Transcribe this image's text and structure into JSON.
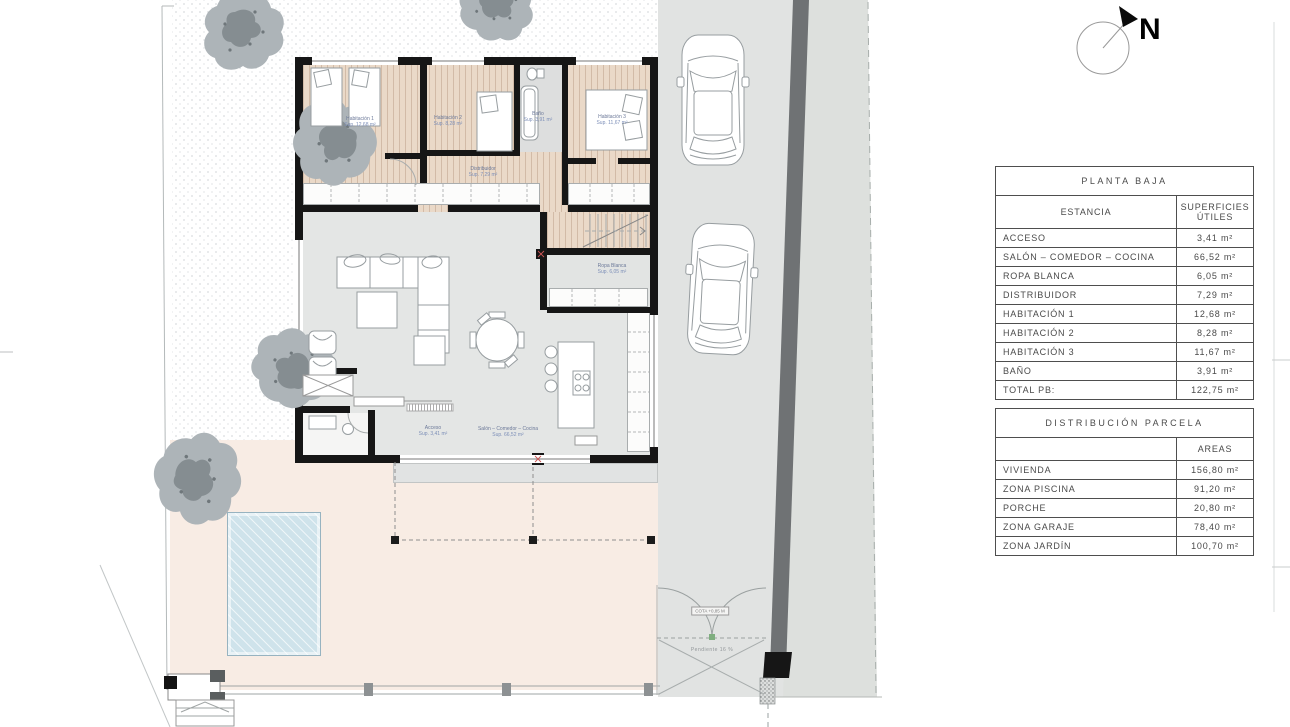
{
  "compass": {
    "north_label": "N"
  },
  "tables": {
    "planta_baja": {
      "title": "PLANTA BAJA",
      "col_room": "ESTANCIA",
      "col_area_line1": "SUPERFICIES",
      "col_area_line2": "ÚTILES",
      "rows": [
        {
          "name": "ACCESO",
          "value": "3,41 m²"
        },
        {
          "name": "SALÓN – COMEDOR – COCINA",
          "value": "66,52 m²"
        },
        {
          "name": "ROPA BLANCA",
          "value": "6,05 m²"
        },
        {
          "name": "DISTRIBUIDOR",
          "value": "7,29 m²"
        },
        {
          "name": "HABITACIÓN 1",
          "value": "12,68 m²"
        },
        {
          "name": "HABITACIÓN 2",
          "value": "8,28 m²"
        },
        {
          "name": "HABITACIÓN 3",
          "value": "11,67 m²"
        },
        {
          "name": "BAÑO",
          "value": "3,91 m²"
        },
        {
          "name": "TOTAL PB:",
          "value": "122,75 m²"
        }
      ]
    },
    "distribucion_parcela": {
      "title": "DISTRIBUCIÓN PARCELA",
      "col_area": "AREAS",
      "rows": [
        {
          "name": "VIVIENDA",
          "value": "156,80 m²"
        },
        {
          "name": "ZONA PISCINA",
          "value": "91,20 m²"
        },
        {
          "name": "PORCHE",
          "value": "20,80 m²"
        },
        {
          "name": "ZONA GARAJE",
          "value": "78,40 m²"
        },
        {
          "name": "ZONA JARDÍN",
          "value": "100,70 m²"
        }
      ]
    }
  },
  "plan_labels": {
    "habitacion1": {
      "name": "Habitación 1",
      "area": "Sup. 12,68 m²"
    },
    "habitacion2": {
      "name": "Habitación 2",
      "area": "Sup. 8,28 m²"
    },
    "habitacion3": {
      "name": "Habitación 3",
      "area": "Sup. 11,67 m²"
    },
    "bano": {
      "name": "Baño",
      "area": "Sup. 3,91 m²"
    },
    "distribuidor": {
      "name": "Distribuidor",
      "area": "Sup. 7,29 m²"
    },
    "ropa_blanca": {
      "name": "Ropa Blanca",
      "area": "Sup. 6,05 m²"
    },
    "acceso": {
      "name": "Acceso",
      "area": "Sup. 3,41 m²"
    },
    "salon": {
      "name": "Salón – Comedor – Cocina",
      "area": "Sup. 66,52 m²"
    },
    "cota": "COTA +0,85 M",
    "pendiente": "Pendiente 16 %"
  },
  "colors": {
    "wall": "#161616",
    "wood_floor": "#ead9c8",
    "terrace": "#f8ece4",
    "pool": "#cfe3eb",
    "garage": "#e1e3e2",
    "driveway_strip": "#6f7274",
    "label_blue": "#7d8fb8"
  }
}
